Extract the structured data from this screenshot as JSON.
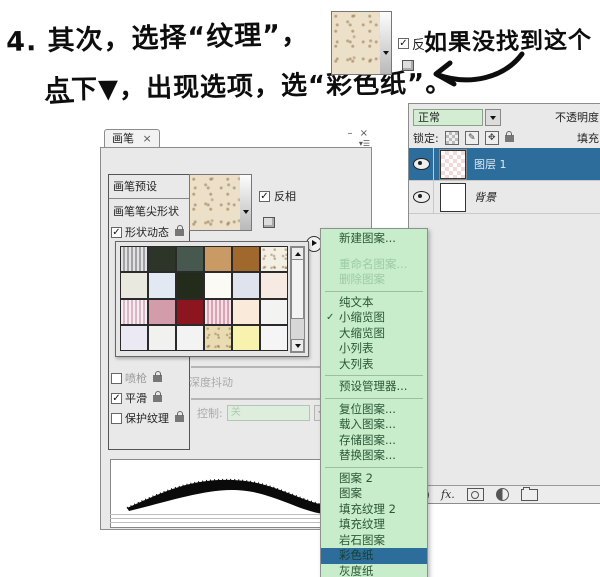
{
  "annotation": {
    "line1": "4. 其次，选择“纹理”，",
    "line1b": "如果没找到这个",
    "line2": "点下▼，出现选项，选“彩色纸”。",
    "mini_invert_label": "反"
  },
  "brush_panel": {
    "tab_label": "画笔",
    "tab_close": "×",
    "winbtns": "– ×",
    "preset_item": "画笔预设",
    "tip_shape_item": "画笔笔尖形状",
    "shape_dynamics_item": "形状动态",
    "airbrush_item": "喷枪",
    "smoothing_item": "平滑",
    "protect_texture_item": "保护纹理",
    "invert_label": "反相",
    "scale_value": "76%",
    "depth_jitter_label": "深度抖动",
    "control_label": "控制:",
    "control_value": "关",
    "check_glyph": "✓"
  },
  "swatches": {
    "cells": [
      {
        "color": "#b7b7bb",
        "pattern": "stripes"
      },
      {
        "color": "#2c3527"
      },
      {
        "color": "#47594e"
      },
      {
        "color": "#c99a63"
      },
      {
        "color": "#a1682e"
      },
      {
        "color": "#f3efe3",
        "pattern": "speckle"
      },
      {
        "color": "#eae9e0"
      },
      {
        "color": "#e3e9f2"
      },
      {
        "color": "#232b1b"
      },
      {
        "color": "#fbfaf4"
      },
      {
        "color": "#dfe3ed"
      },
      {
        "color": "#f7eae2"
      },
      {
        "color": "#ecdae2",
        "pattern": "pinkstripes"
      },
      {
        "color": "#d39cab"
      },
      {
        "color": "#8c1520"
      },
      {
        "color": "#edbccb",
        "pattern": "pinkstripes"
      },
      {
        "color": "#f9ead9"
      },
      {
        "color": "#f3f3f1"
      },
      {
        "color": "#ebe9f4"
      },
      {
        "color": "#f1f1ef"
      },
      {
        "color": "#f3f3f3"
      },
      {
        "color": "#e9dcb2",
        "pattern": "speckle"
      },
      {
        "color": "#f7f3ae"
      },
      {
        "color": "#f5f5f5"
      }
    ]
  },
  "pattern_menu": {
    "items": [
      {
        "label": "新建图案..."
      },
      {
        "sep": "space"
      },
      {
        "label": "重命名图案...",
        "disabled": true
      },
      {
        "label": "删除图案",
        "disabled": true
      },
      {
        "sep": "line"
      },
      {
        "label": "纯文本"
      },
      {
        "label": "小缩览图",
        "checked": true
      },
      {
        "label": "大缩览图"
      },
      {
        "label": "小列表"
      },
      {
        "label": "大列表"
      },
      {
        "sep": "line"
      },
      {
        "label": "预设管理器..."
      },
      {
        "sep": "line"
      },
      {
        "label": "复位图案..."
      },
      {
        "label": "载入图案..."
      },
      {
        "label": "存储图案..."
      },
      {
        "label": "替换图案..."
      },
      {
        "sep": "line"
      },
      {
        "label": "图案 2"
      },
      {
        "label": "图案"
      },
      {
        "label": "填充纹理 2"
      },
      {
        "label": "填充纹理"
      },
      {
        "label": "岩石图案"
      },
      {
        "label": "彩色纸",
        "selected": true
      },
      {
        "label": "灰度纸"
      }
    ]
  },
  "layers_panel": {
    "blend_mode": "正常",
    "opacity_label": "不透明度:",
    "lock_label": "锁定:",
    "fill_label": "填充:",
    "fx_label": "fx.",
    "layers": [
      {
        "name": "图层 1",
        "selected": true,
        "thumb": "checker"
      },
      {
        "name": "背景",
        "italic": true,
        "thumb": "white"
      }
    ]
  }
}
